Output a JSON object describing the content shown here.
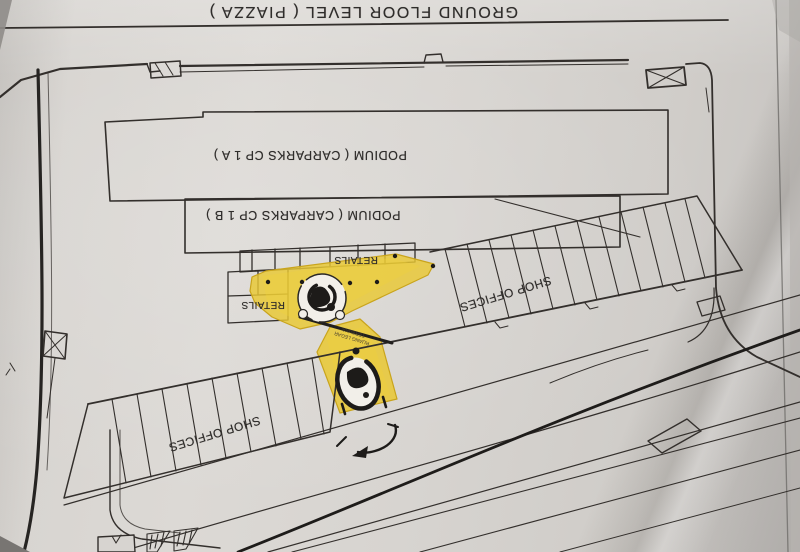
{
  "meta": {
    "description": "Photograph of a printed architectural ground-floor site plan, viewed upside down",
    "paper_color": "#d7d4d0",
    "ink_color": "#2e2c2a",
    "highlight_color": "#e9c832"
  },
  "title": {
    "text": "GROUND FLOOR LEVEL ( PIAZZA )"
  },
  "areas": {
    "podium_cp1a": {
      "label": "PODIUM ( CARPARKS CP 1 A )"
    },
    "podium_cp1b": {
      "label": "PODIUM ( CARPARKS CP 1 B )"
    },
    "retails_top": {
      "label": "RETAILS"
    },
    "retails_left": {
      "label": "RETAILS"
    },
    "shop_offices_upper": {
      "label": "SHOP OFFICES"
    },
    "shop_offices_lower": {
      "label": "SHOP OFFICES"
    },
    "piazza_highlight": {
      "label": "RUANG LEGAR TERBUKA",
      "label_lines": [
        "RUANG LEGAR",
        "TERBUKA"
      ],
      "highlight_color": "#e9c832"
    }
  }
}
